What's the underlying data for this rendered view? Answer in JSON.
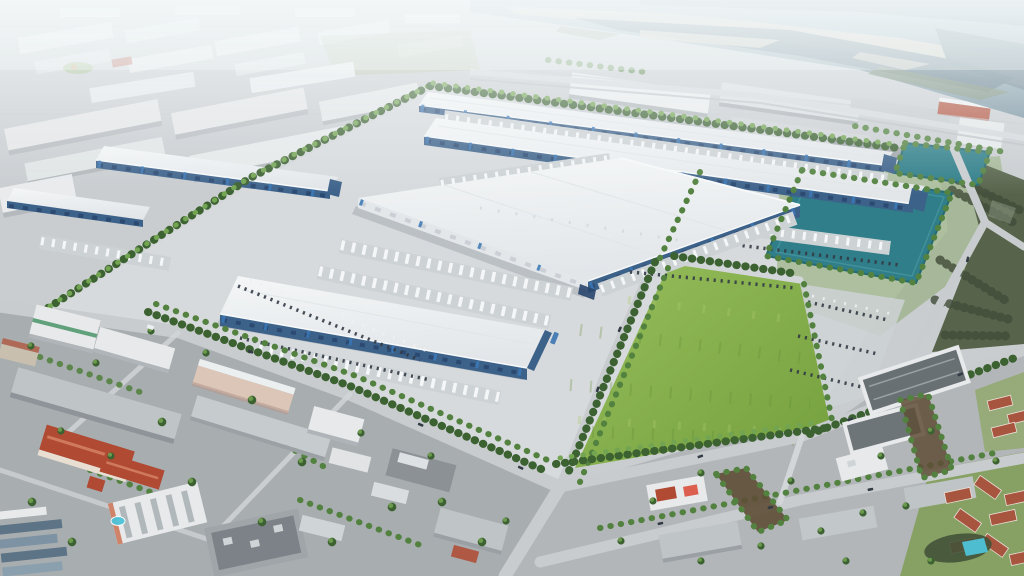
{
  "scene": {
    "type": "aerial-architectural-rendering",
    "subject": "Oblique aerial rendering of a new master-planned logistics industrial park with large white warehouses, truck courts, tree-lined drives, two teal retention ponds and a green field, surrounded by existing low-rise city blocks, with lakes and marsh on the hazy horizon",
    "time_of_day": "daytime, hazy bright light",
    "features": {
      "new-warehouses": 6,
      "retention-ponds": 2,
      "grass-field": 1,
      "distant-water-bodies": "lakes and marsh along top edge",
      "southwest-quadrant": "existing urban blocks: red-tile-roof hotel, white mid-rise with pool, offices, container yard",
      "southeast-quadrant": "apartment blocks, red-tile condo village, small brown ponds, pool, commercial strip",
      "east-edge": "dark scrubland preserve",
      "landscaping": "dense street-tree and palm rows, parking lots with cars, docked white trailers"
    }
  },
  "palette": {
    "ground": "#c9cdd0",
    "apron": "#d7dadc",
    "road": "#c8ccce",
    "road-light": "#d3d6d8",
    "roof-white": "#eef0f2",
    "wall-white": "#e3e7ea",
    "glass-blue": "#3d628a",
    "glass-navy": "#28456c",
    "accent-blue": "#3a77b5",
    "trailer": "#f4f6f7",
    "dock": "#cdd2d5",
    "shadow": "#5a6675",
    "tree-dark": "#3d6232",
    "tree-mid": "#538240",
    "tree-light": "#73a452",
    "grass-light": "#95bc59",
    "grass": "#7aa443",
    "grass-dark": "#649038",
    "pond": "#2f7e89",
    "pond-deep": "#256974",
    "pond-light": "#55a2aa",
    "water-far": "#87a0ad",
    "water-dark": "#5b7584",
    "marsh": "#cfc9b6",
    "scrub": "#57644b",
    "scrub-dark": "#414c38",
    "urban-asphalt": "#a8adb0",
    "urban-gray": "#bfc4c6",
    "urban-dark": "#888e92",
    "urban-white": "#e7e9ea",
    "red-roof": "#b04a33",
    "tile-roof": "#a85540",
    "pink-wall": "#dcc6b8",
    "brown-pond": "#5e4e36",
    "pool": "#4ec3d8",
    "car": "#333b45",
    "haze": "#f4f8fa",
    "verge": "#84a361",
    "lawn": "#7f9e55",
    "golf": "#a8ba8e"
  }
}
